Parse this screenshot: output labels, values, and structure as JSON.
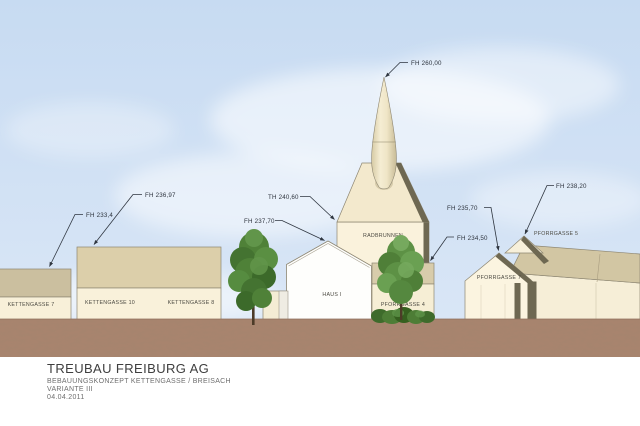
{
  "drawing": {
    "type": "architectural-elevation",
    "annotations": {
      "kettengasse7_fh": "FH 233,4",
      "kettengasse10_fh": "FH 236,97",
      "haus1_fh": "FH 237,70",
      "radbrunnen_th": "TH 240,60",
      "spire_fh": "FH 260,00",
      "pforrgasse4_fh": "FH 234,50",
      "pforrgasse7_fh": "FH 235,70",
      "pforrgasse5_fh": "FH 238,20"
    },
    "building_labels": {
      "kettengasse7": "KETTENGASSE 7",
      "kettengasse10": "KETTENGASSE 10",
      "kettengasse8": "KETTENGASSE 8",
      "haus1": "HAUS I",
      "radbrunnen": "RADBRUNNEN",
      "pforrgasse4": "PFORRGASSE 4",
      "pforrgasse7": "PFORRGASSE 7",
      "pforrgasse5": "PFORRGASSE 5"
    },
    "colors": {
      "sky": "#cfe0f4",
      "ground": "#a8846e",
      "facade_cream": "#f8f0d9",
      "roof_tan": "#dbcea9",
      "roof_dark_edge": "#6a654e",
      "haus1_white": "#fefefc",
      "tree_green": "#568c40",
      "annotation_ink": "#2f3640"
    }
  },
  "title_block": {
    "company": "TREUBAU FREIBURG AG",
    "project": "BEBAUUNGSKONZEPT KETTENGASSE / BREISACH",
    "variant": "VARIANTE III",
    "date": "04.04.2011"
  }
}
